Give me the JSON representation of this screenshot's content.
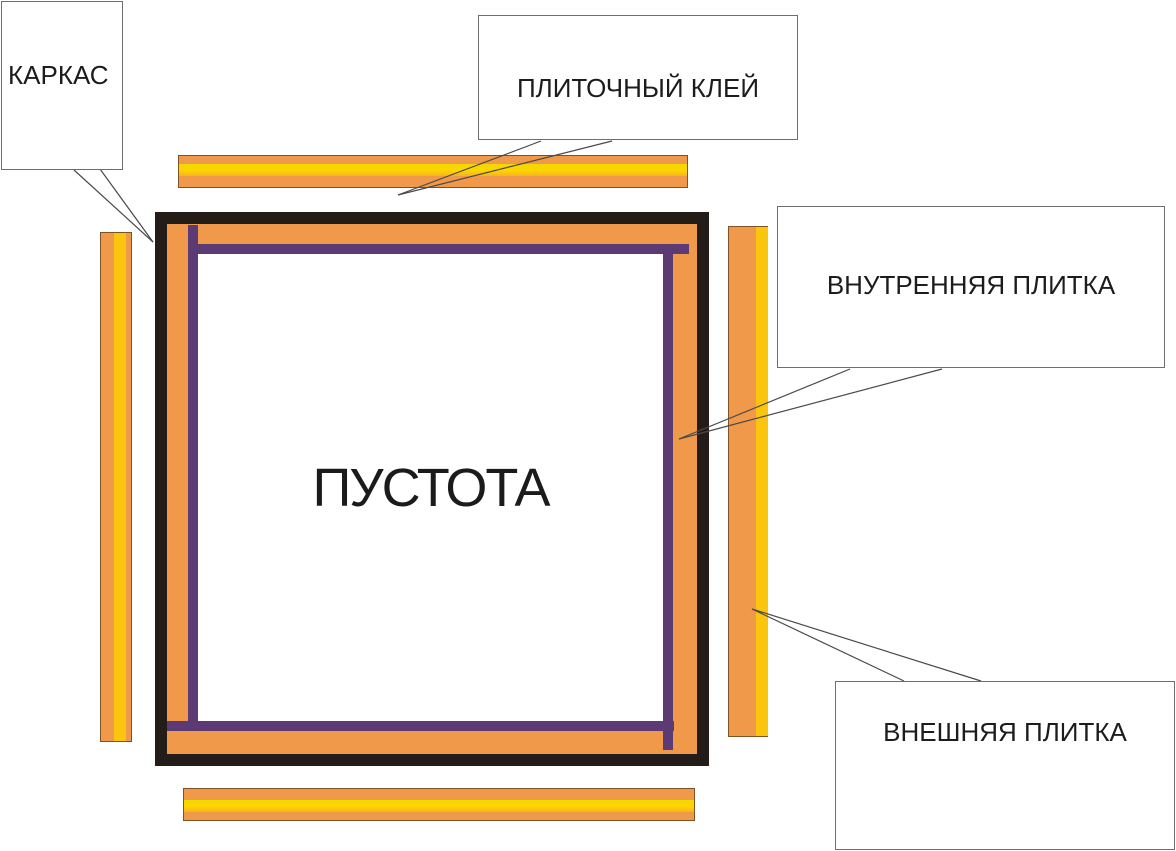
{
  "diagram": {
    "callouts": {
      "frame": {
        "label": "КАРКАС"
      },
      "adhesive": {
        "label": "ПЛИТОЧНЫЙ КЛЕЙ"
      },
      "inner_tile": {
        "label": "ВНУТРЕННЯЯ ПЛИТКА"
      },
      "outer_tile": {
        "label": "ВНЕШНЯЯ ПЛИТКА"
      }
    },
    "void_label": "ПУСТОТА",
    "colors": {
      "tile_orange": "#F0994B",
      "adhesive_yellow": "#FFD400",
      "inner_tile_purple": "#5C3A74",
      "frame_black": "#231C19",
      "callout_border": "#6E6E6E",
      "leader_line": "#4A4A4A"
    }
  }
}
